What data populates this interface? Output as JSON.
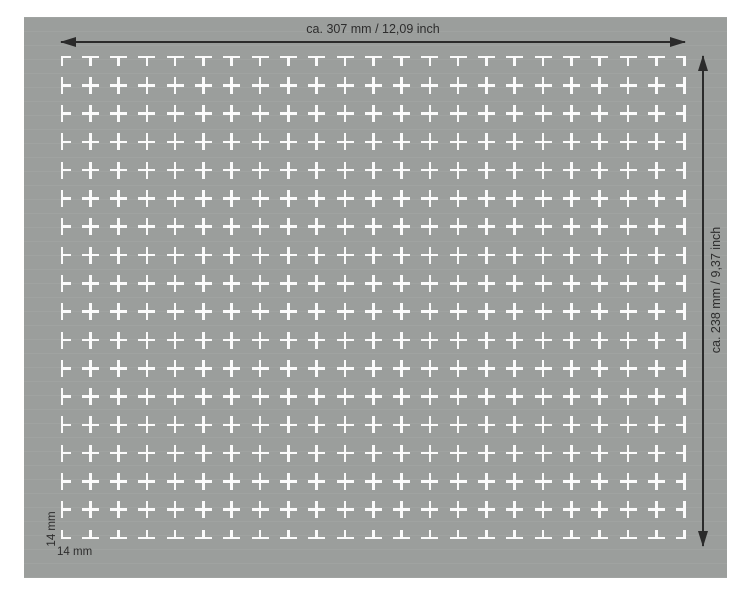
{
  "diagram": {
    "type": "dimensioned-grid-mat",
    "background_color": "#ffffff",
    "panel_color": "#9b9e9c"
  },
  "grid": {
    "rows": 18,
    "cols": 23,
    "spacing_mm": 14,
    "mark_shape": "cross",
    "mark_color": "#fbfbfb",
    "px": {
      "origin_x": 62,
      "origin_y": 57,
      "spacing_x": 28.3,
      "spacing_y": 28.3,
      "mark_size": 17,
      "mark_thickness": 2.6
    }
  },
  "dimensions": {
    "width_label": "ca. 307 mm / 12,09 inch",
    "height_label": "ca. 238 mm / 9,37 inch",
    "row_spacing_label": "14 mm",
    "column_spacing_label": "14 mm",
    "arrow_color": "#2b2b2b",
    "text_color": "#2d2d2d"
  }
}
